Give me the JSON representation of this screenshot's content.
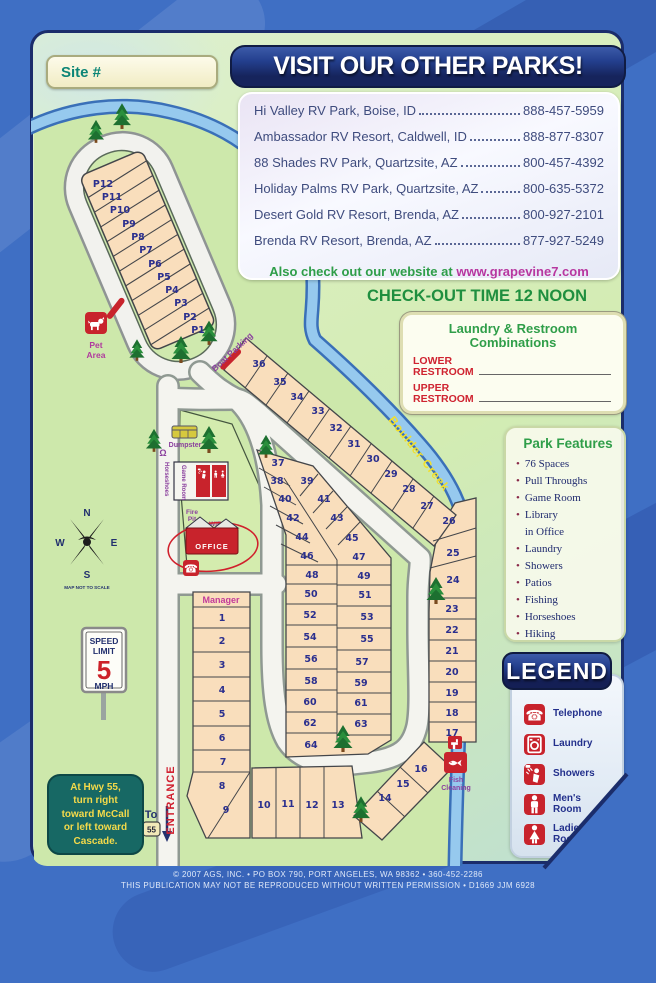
{
  "site_box": {
    "label": "Site #"
  },
  "other_parks": {
    "title": "VISIT OUR OTHER PARKS!",
    "entries": [
      {
        "name": "Hi Valley RV Park, Boise, ID",
        "phone": "888-457-5959"
      },
      {
        "name": "Ambassador RV Resort, Caldwell, ID",
        "phone": "888-877-8307"
      },
      {
        "name": "88 Shades RV Park, Quartzsite, AZ",
        "phone": "800-457-4392"
      },
      {
        "name": "Holiday Palms RV Park, Quartzsite, AZ",
        "phone": "800-635-5372"
      },
      {
        "name": "Desert Gold RV Resort, Brenda, AZ",
        "phone": "800-927-2101"
      },
      {
        "name": "Brenda RV Resort, Brenda, AZ",
        "phone": "877-927-5249"
      }
    ],
    "website_prefix": "Also check out our website at ",
    "website_url": "www.grapevine7.com"
  },
  "checkout_text": "CHECK-OUT TIME 12 NOON",
  "combinations": {
    "title": "Laundry & Restroom\nCombinations",
    "lower_label": "LOWER\nRESTROOM",
    "upper_label": "UPPER\nRESTROOM"
  },
  "park_features": {
    "title": "Park Features",
    "items": [
      "76 Spaces",
      "Pull Throughs",
      "Game Room",
      "Library\nin Office",
      "Laundry",
      "Showers",
      "Patios",
      "Fishing",
      "Horseshoes",
      "Hiking"
    ]
  },
  "legend": {
    "title": "LEGEND",
    "items": [
      {
        "icon": "telephone-icon",
        "label": "Telephone"
      },
      {
        "icon": "laundry-icon",
        "label": "Laundry"
      },
      {
        "icon": "showers-icon",
        "label": "Showers"
      },
      {
        "icon": "mens-room-icon",
        "label": "Men's\nRoom"
      },
      {
        "icon": "ladies-room-icon",
        "label": "Ladies'\nRoom"
      }
    ]
  },
  "map": {
    "creek_label": "Boulder Creek",
    "entrance_label": "ENTRANCE",
    "manager_label": "Manager",
    "boat_parking_label": "Boat Parking",
    "pet_area": {
      "line1": "Pet",
      "line2": "Area"
    },
    "dumpster_label": "Dumpster",
    "fish_cleaning": {
      "line1": "Fish",
      "line2": "Cleaning"
    },
    "office_label": "OFFICE",
    "game_room_label": "Game Room",
    "horseshoes_label": "Horseshoes",
    "fire_pit": {
      "line1": "Fire",
      "line2": "Pit"
    },
    "wifi_label": "WiFi",
    "compass": {
      "n": "N",
      "e": "E",
      "s": "S",
      "w": "W",
      "note": "MAP NOT TO SCALE"
    },
    "speed_sign": {
      "line1": "SPEED",
      "line2": "LIMIT",
      "number": "5",
      "unit": "MPH"
    },
    "hwy_note": "At Hwy 55,\nturn right\ntoward McCall\nor left toward\nCascade.",
    "to_hwy": {
      "to": "To",
      "shield": "55"
    },
    "pull_sites": [
      "P12",
      "P11",
      "P10",
      "P9",
      "P8",
      "P7",
      "P6",
      "P5",
      "P4",
      "P3",
      "P2",
      "P1"
    ],
    "sites_left": [
      "1",
      "2",
      "3",
      "4",
      "5",
      "6",
      "7",
      "8",
      "9"
    ],
    "sites_bottom": [
      "10",
      "11",
      "12",
      "13"
    ],
    "sites_diag": [
      "14",
      "15",
      "16"
    ],
    "sites_right": [
      "17",
      "18",
      "19",
      "20",
      "21",
      "22",
      "23",
      "24",
      "25",
      "26"
    ],
    "sites_creek": [
      "27",
      "28",
      "29",
      "30",
      "31",
      "32",
      "33",
      "34",
      "35",
      "36"
    ],
    "sites_mid_left": [
      "37",
      "38",
      "40",
      "42",
      "44",
      "46",
      "48",
      "50",
      "52",
      "54",
      "56",
      "58",
      "60",
      "62",
      "64"
    ],
    "sites_mid_right": [
      "39",
      "41",
      "43",
      "45",
      "47",
      "49",
      "51",
      "53",
      "55",
      "57",
      "59",
      "61",
      "63"
    ]
  },
  "footer": {
    "line1": "© 2007  AGS, INC. • PO BOX 790, PORT ANGELES, WA 98362 • 360-452-2286",
    "line2": "THIS PUBLICATION MAY NOT BE REPRODUCED WITHOUT WRITTEN PERMISSION • D1669 JJM 6928"
  }
}
